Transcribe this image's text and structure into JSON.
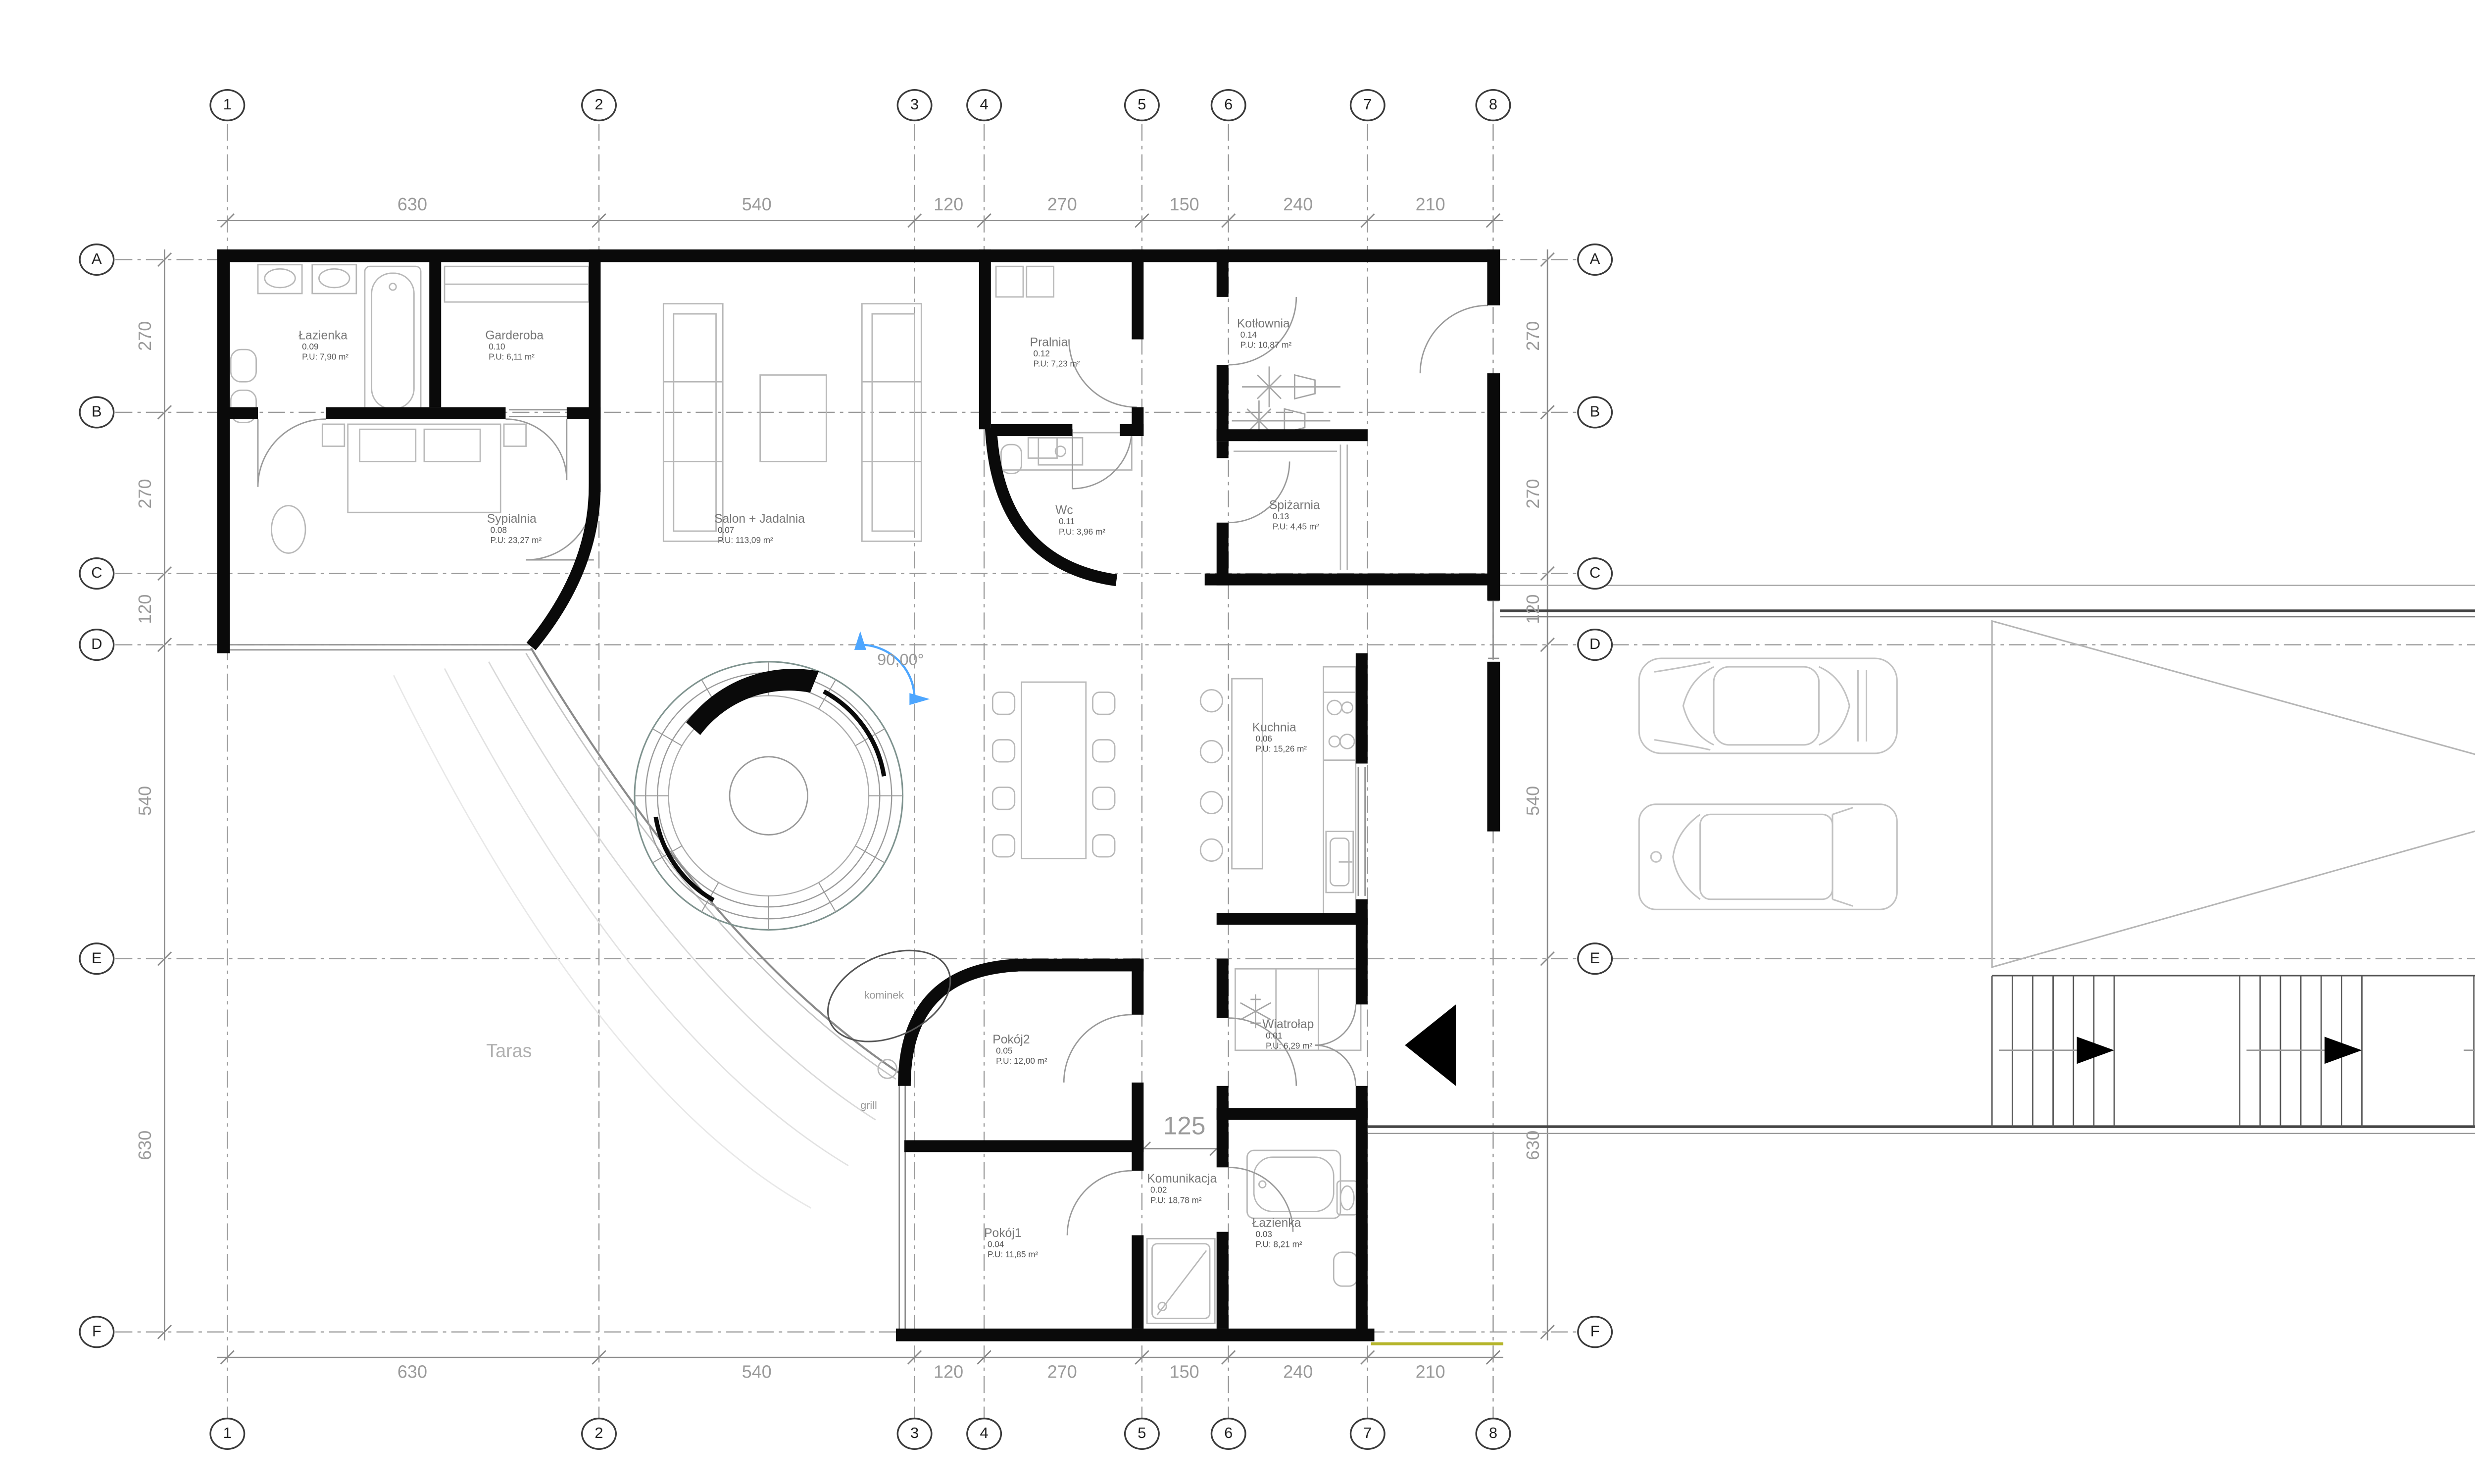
{
  "drawing": {
    "type": "floor-plan",
    "language": "pl",
    "accent_blue": "#4da6ff",
    "wall_color": "#0a0a0a",
    "grid_color": "#999999",
    "dim_text_color": "#9a9a9a",
    "marker_line_yellow": "#b5b52a"
  },
  "grid": {
    "cols": [
      {
        "id": "1"
      },
      {
        "id": "2"
      },
      {
        "id": "3"
      },
      {
        "id": "4"
      },
      {
        "id": "5"
      },
      {
        "id": "6"
      },
      {
        "id": "7"
      },
      {
        "id": "8"
      }
    ],
    "rows": [
      {
        "id": "A"
      },
      {
        "id": "B"
      },
      {
        "id": "C"
      },
      {
        "id": "D"
      },
      {
        "id": "E"
      },
      {
        "id": "F"
      }
    ]
  },
  "dims_top": [
    "630",
    "540",
    "120",
    "270",
    "150",
    "240",
    "210"
  ],
  "dims_bottom": [
    "630",
    "540",
    "120",
    "270",
    "150",
    "240",
    "210"
  ],
  "dims_left": [
    "270",
    "270",
    "120",
    "540",
    "630"
  ],
  "dims_right": [
    "270",
    "270",
    "120",
    "540",
    "630"
  ],
  "dim_interior": "125",
  "rooms": [
    {
      "name": "Wiatrołap",
      "num": "0.01",
      "area": "P.U: 6,29 m²"
    },
    {
      "name": "Komunikacja",
      "num": "0.02",
      "area": "P.U: 18,78 m²"
    },
    {
      "name": "Łazienka",
      "num": "0.03",
      "area": "P.U: 8,21 m²"
    },
    {
      "name": "Pokój1",
      "num": "0.04",
      "area": "P.U: 11,85 m²"
    },
    {
      "name": "Pokój2",
      "num": "0.05",
      "area": "P.U: 12,00 m²"
    },
    {
      "name": "Kuchnia",
      "num": "0.06",
      "area": "P.U: 15,26 m²"
    },
    {
      "name": "Salon + Jadalnia",
      "num": "0.07",
      "area": "P.U: 113,09 m²"
    },
    {
      "name": "Sypialnia",
      "num": "0.08",
      "area": "P.U: 23,27 m²"
    },
    {
      "name": "Łazienka",
      "num": "0.09",
      "area": "P.U: 7,90 m²"
    },
    {
      "name": "Garderoba",
      "num": "0.10",
      "area": "P.U: 6,11 m²"
    },
    {
      "name": "Wc",
      "num": "0.11",
      "area": "P.U: 3,96 m²"
    },
    {
      "name": "Pralnia",
      "num": "0.12",
      "area": "P.U: 7,23 m²"
    },
    {
      "name": "Spiżarnia",
      "num": "0.13",
      "area": "P.U: 4,45 m²"
    },
    {
      "name": "Kotłownia",
      "num": "0.14",
      "area": "P.U: 10,87 m²"
    }
  ],
  "annotations": {
    "taras": "Taras",
    "kominek": "kominek",
    "grill": "grill",
    "angle": "90,00°"
  }
}
